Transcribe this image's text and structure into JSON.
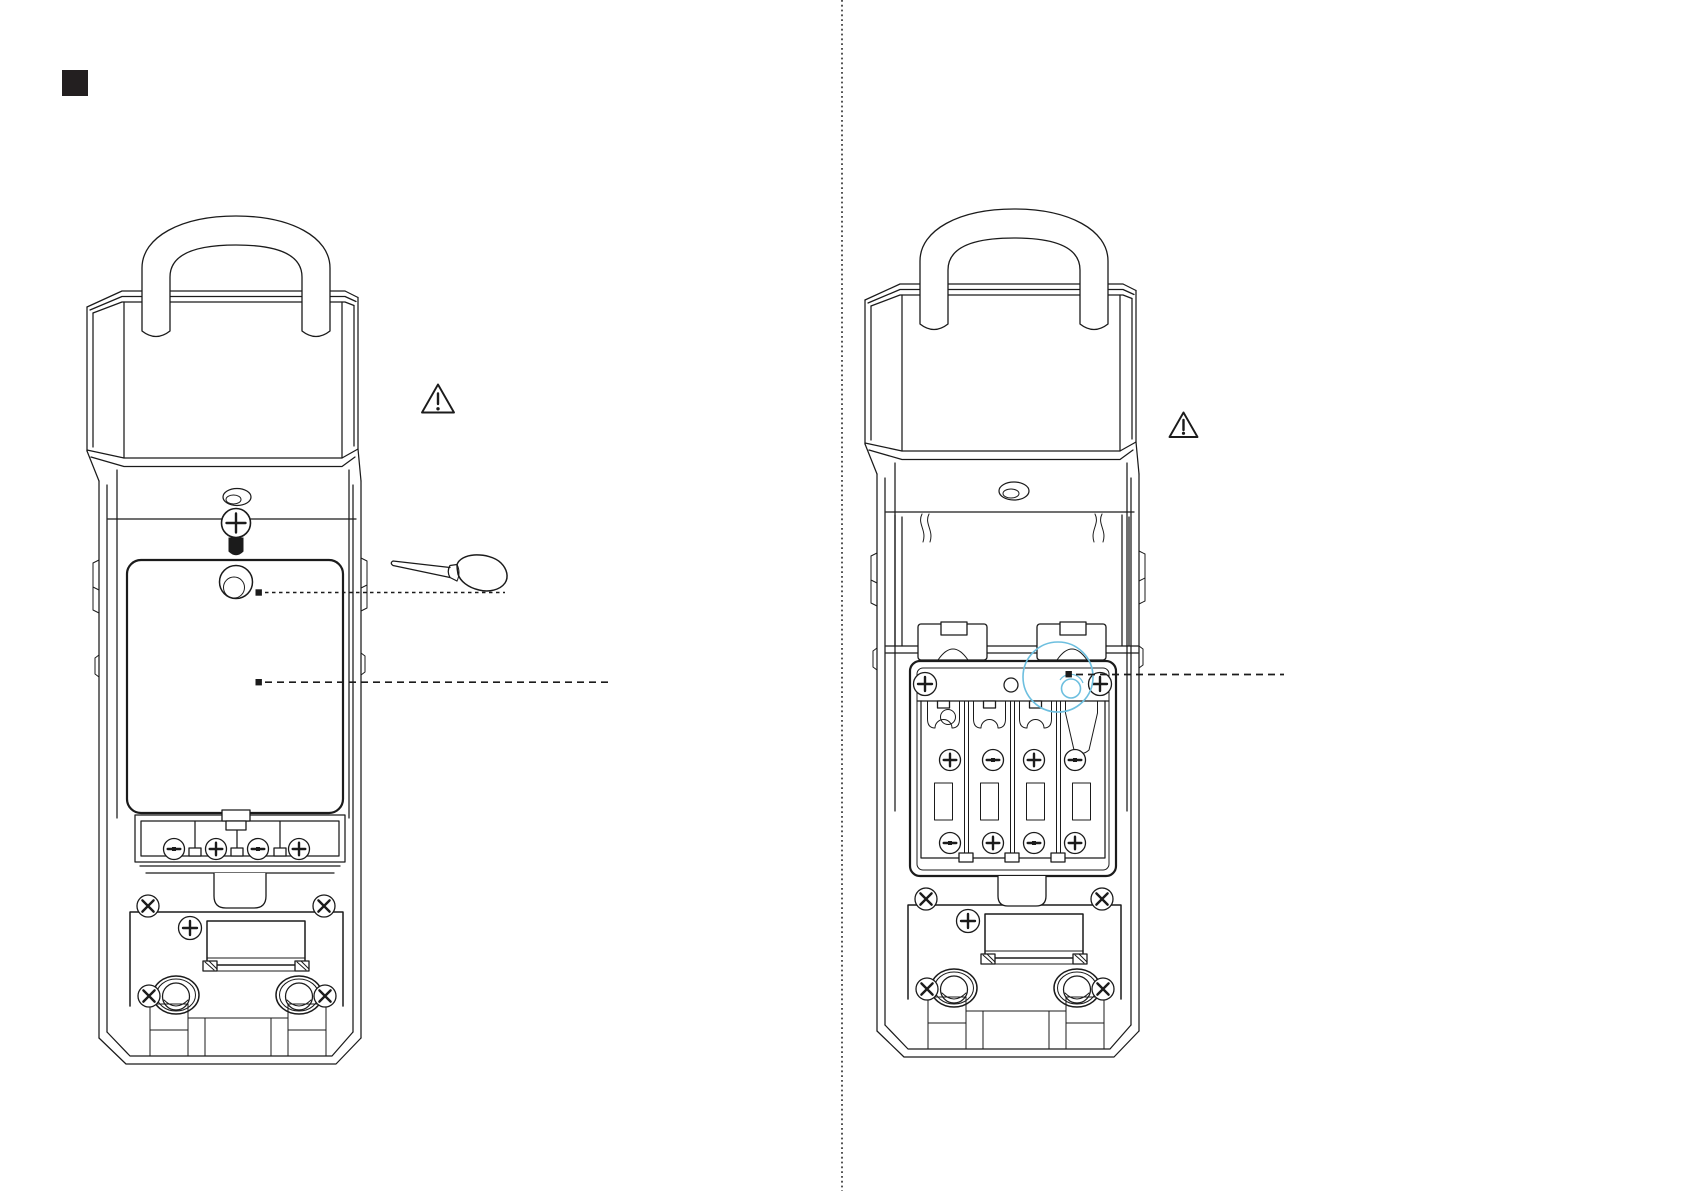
{
  "page": {
    "width": 1684,
    "height": 1191,
    "background": "#ffffff",
    "kind": "instruction-manual-illustration",
    "visible_text": ""
  },
  "theme": {
    "line_color": "#1b1b1b",
    "marker_color": "#231f20",
    "highlight_color": "#6dbfdf",
    "paper_color": "#ffffff"
  },
  "section_marker": {
    "shape": "filled-black-square",
    "position": "top-left"
  },
  "divider": {
    "orientation": "vertical",
    "style": "dotted",
    "position": "page-center"
  },
  "figures": [
    {
      "id": "lockbox-rear-cover-closed",
      "side": "left",
      "description": "Rear view of shackle lock box; battery cover closed; Phillips fixing screw with black plug above the cover; finger recess on cover; terminal screw row below; mounting plate with window, two round bosses and four cross screws",
      "terminal_screw_slots": [
        "minus",
        "plus",
        "minus",
        "plus"
      ],
      "callouts": [
        {
          "marker": "small-black-square",
          "points_to": "screw-area-on-battery-cover",
          "line_style": "fine-dashed"
        },
        {
          "marker": "small-black-square",
          "points_to": "battery-cover-surface",
          "line_style": "dashed"
        }
      ],
      "icons": [
        "warning-triangle",
        "screwdriver"
      ]
    },
    {
      "id": "lockbox-rear-cover-removed",
      "side": "right",
      "description": "Rear view of shackle lock box; battery cover removed exposing four-slot battery tray with two fixing screws and polarity contacts",
      "battery_slots": 4,
      "contact_polarity_top_row": [
        "plus",
        "minus",
        "plus",
        "minus"
      ],
      "contact_polarity_bottom_row": [
        "minus",
        "plus",
        "minus",
        "plus"
      ],
      "highlight": {
        "shape": "double-circle",
        "color": "#6dbfdf",
        "points_to": "cover-screw-hole-on-tray-top-bar"
      },
      "callouts": [
        {
          "marker": "small-black-square",
          "points_to": "cover-screw-hole",
          "line_style": "dashed"
        }
      ],
      "icons": [
        "warning-triangle"
      ]
    }
  ]
}
